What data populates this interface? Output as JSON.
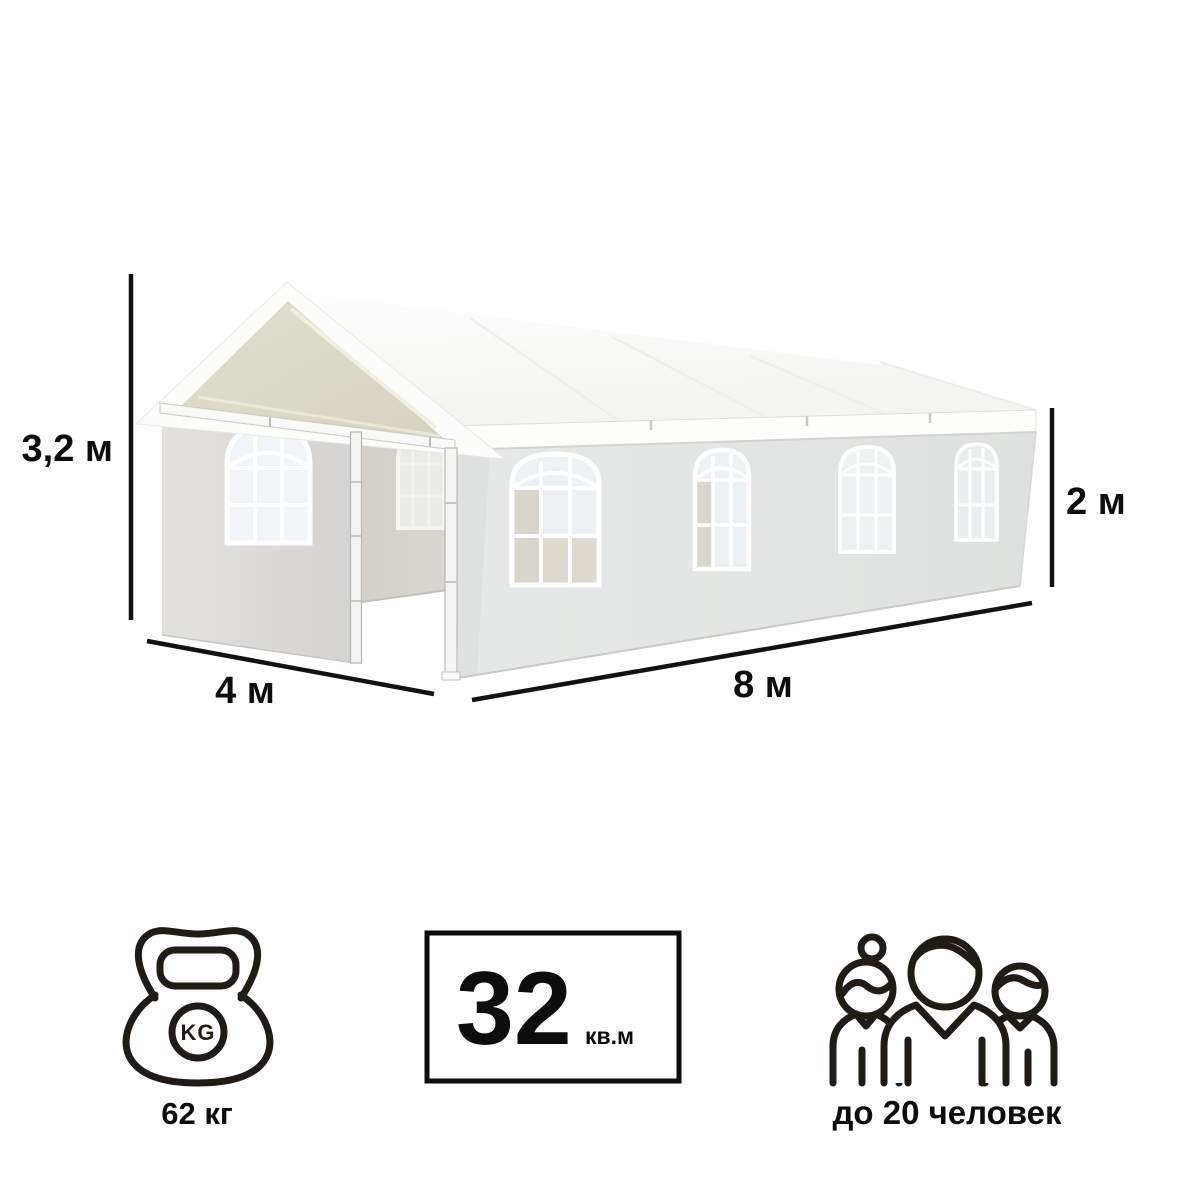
{
  "background_color": "#ffffff",
  "illustration": {
    "subject": "white gable party tent 3D render",
    "roof_color": "#f9f9f7",
    "side_wall_color": "#e4e6e5",
    "front_wall_color": "#dbdad7",
    "gable_interior_color": "#d9d7c4",
    "window_pane_color": "#eef1f3"
  },
  "dimensions": {
    "total_height": {
      "label": "3,2 м"
    },
    "width": {
      "label": "4 м"
    },
    "length": {
      "label": "8 м"
    },
    "side_height": {
      "label": "2 м"
    }
  },
  "specs": {
    "weight": {
      "icon": "kettlebell-icon",
      "kettlebell_text": "KG",
      "label": "62 кг"
    },
    "area": {
      "value": "32",
      "unit": "кв.м"
    },
    "capacity": {
      "icon": "people-icon",
      "label": "до 20 человек"
    }
  },
  "text_color": "#0d0d0d",
  "icon_color": "#201b15",
  "line_color": "#121212"
}
